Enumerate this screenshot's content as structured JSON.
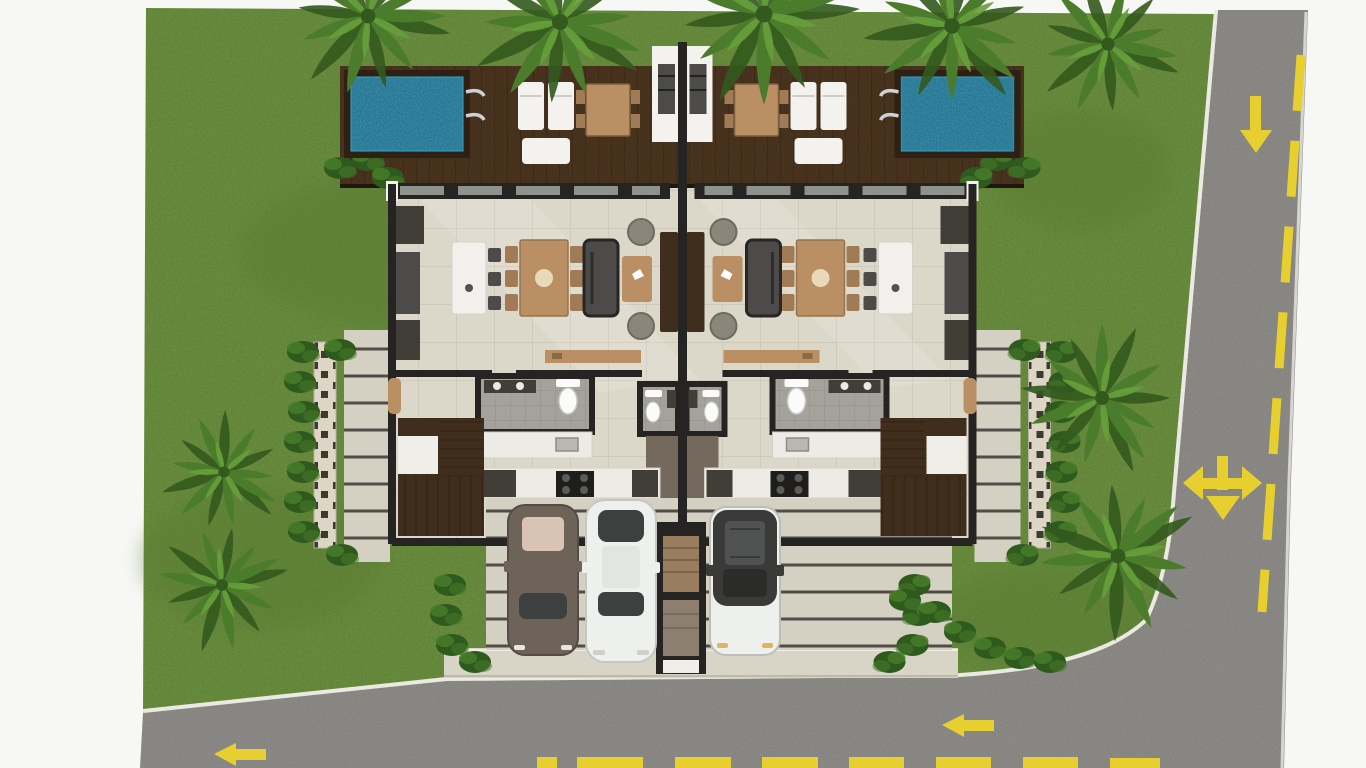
{
  "meta": {
    "description": "Top-down 3D rendered site plan of a mirrored duplex villa with private pools, landscaped garden, driveway with three parked cars, and surrounding roads",
    "view": "top-down architectural render",
    "units": 2
  },
  "colors": {
    "paper": "#f7f7f5",
    "grass": "#6d9340",
    "grassDark": "#55772e",
    "road": "#8f8d89",
    "roadEdge": "#7f7d79",
    "marking": "#e7cf2f",
    "curb": "#ebe9e2",
    "sidewalk": "#d9d5c6",
    "deck": "#4a341f",
    "deckLine": "#3a2815",
    "poolFrame": "#2e2113",
    "pool": "#176a88",
    "poolLight": "#38a0c0",
    "wall": "#262422",
    "floor": "#dcd8c9",
    "floorLine": "#cbc7b8",
    "bath": "#a5a19b",
    "bathLine": "#938f89",
    "patio": "#d5d1c2",
    "patioLine": "#514d46",
    "screen": "#ddd6c4",
    "screenHole": "#3d3a33",
    "hedge": "#2f5a1e",
    "hedgeLight": "#477c2a",
    "palmDark": "#33591d",
    "palm": "#4b7c2c",
    "palmLight": "#67a03c",
    "island": "#f1f0ec",
    "counter": "#edebe5",
    "woodTan": "#b98f63",
    "woodMid": "#a07b55",
    "sofa": "#4c4b49",
    "sofaDark": "#2e2d2b",
    "pouf": "#8a8679",
    "whiteFurn": "#f3f2ee",
    "glass": "#8d928c",
    "glassDark": "#3e403f",
    "stairs": "#3f2d1d",
    "landing": "#f0eee8",
    "hall": "#75685c",
    "walkTop": "#9a7c5e",
    "walkBottom": "#8d7e70",
    "steel": "#ccd1d5",
    "stove": "#1f1e1c",
    "applianceDark": "#413d37",
    "carTaupe": "#6e6359",
    "carRoofTan": "#d9c3b2",
    "carWhite": "#eef0ee",
    "carTopDark": "#3a3a38",
    "toilet": "#fbfbf9"
  },
  "scene": {
    "villas": [
      {
        "id": "villa-left",
        "pool": true,
        "deck": true,
        "bedroomsShown": 0,
        "mirrored": false
      },
      {
        "id": "villa-right",
        "pool": true,
        "deck": true,
        "bedroomsShown": 0,
        "mirrored": true
      }
    ],
    "pools": 2,
    "cars": [
      {
        "position": "left",
        "body": "taupe-gray",
        "detail": "tan sunroof"
      },
      {
        "position": "middle",
        "body": "white",
        "detail": "dark glass"
      },
      {
        "position": "right",
        "body": "white",
        "detail": "black roof"
      }
    ],
    "road_markings": {
      "vertical_road": {
        "lane_line": "yellow dashed",
        "arrows": [
          "down",
          "three-way left-right-down"
        ]
      },
      "bottom_road": {
        "lane_line": "yellow dashed",
        "arrows": [
          "left",
          "left"
        ]
      }
    },
    "vegetation": {
      "palm_trees": 9,
      "hedge_rows": 6,
      "privacy_screens": 2
    }
  }
}
